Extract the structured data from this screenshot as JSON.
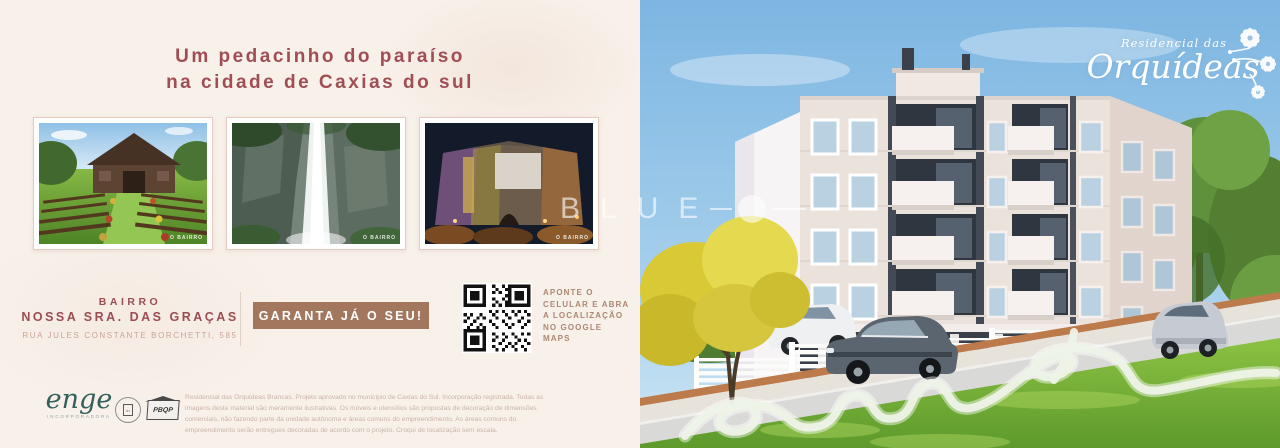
{
  "colors": {
    "background_cream": "#f8f1ea",
    "accent_maroon": "#a04e54",
    "address_tan": "#c9a495",
    "button_brown": "#a3765e",
    "qr_text_brown": "#ad8672",
    "sky_blue": "#86bce4",
    "grass_green": "#7cb840",
    "building_cream": "#ece2dc",
    "building_dark_gray": "#434a55",
    "enge_teal": "#33605c",
    "watermark_white": "rgba(255,255,255,0.6)"
  },
  "left": {
    "title_line1": "Um pedacinho do paraíso",
    "title_line2": "na cidade de Caxias do sul",
    "photos": [
      {
        "name": "garden-vineyard-photo",
        "caption": "O BAIRRO"
      },
      {
        "name": "waterfall-photo",
        "caption": "O BAIRRO"
      },
      {
        "name": "winery-night-photo",
        "caption": "O BAIRRO"
      }
    ],
    "neighborhood": {
      "label": "BAIRRO",
      "name": "NOSSA SRA. DAS GRAÇAS",
      "address": "RUA JULES CONSTANTE BORCHETTI, 585"
    },
    "cta_label": "GARANTA JÁ O SEU!",
    "qr_caption": "APONTE O CELULAR E ABRA A LOCALIZAÇÃO NO GOOGLE MAPS",
    "footer": {
      "enge_logo": "enge",
      "enge_sub": "INCORPORADORA",
      "seal_glyph": "in",
      "pbqp_logo": "PBQP",
      "disclaimer": "Residencial das Orquídeas Brancas. Projeto aprovado no município de Caxias do Sul. Incorporação registrada. Todas as imagens deste material são meramente ilustrativas. Os móveis e utensílios são propostas de decoração de dimensões comerciais, não fazendo parte da unidade autônoma e áreas comuns do empreendimento. As áreas comuns do empreendimento serão entregues decoradas de acordo com o projeto. Croqui de localização sem escala."
    }
  },
  "right": {
    "brand_line1": "Residencial das",
    "brand_line2": "Orquídeas"
  },
  "watermark": {
    "text": "BLUE"
  }
}
